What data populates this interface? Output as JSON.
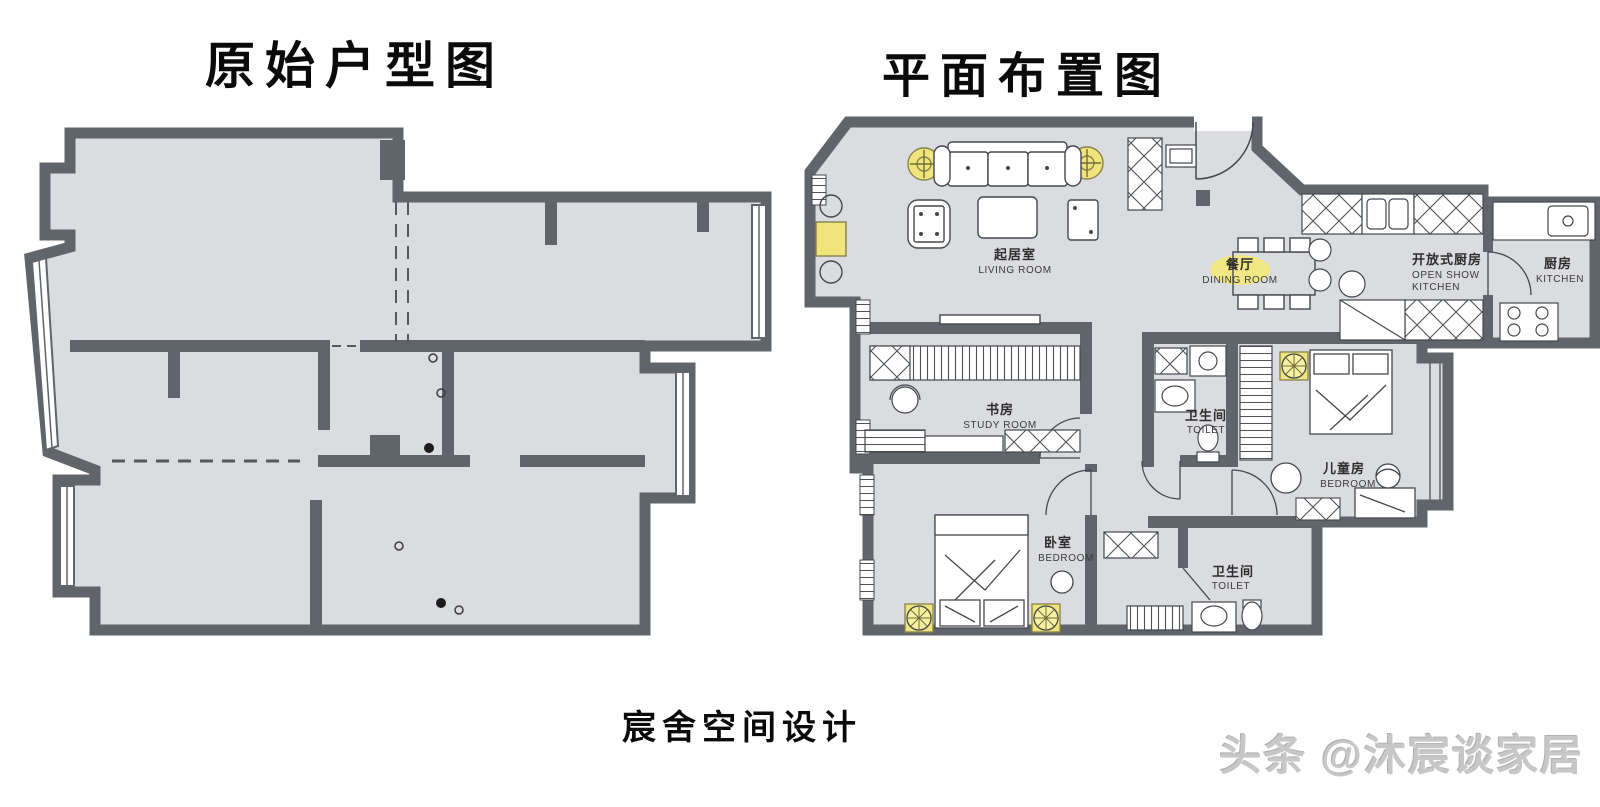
{
  "titles": {
    "left": "原始户型图",
    "right": "平面布置图"
  },
  "footer": {
    "studio": "宸舍空间设计"
  },
  "watermark": {
    "text": "头条 @沐宸谈家居"
  },
  "colors": {
    "wall": "#60656c",
    "floor": "#dbdcdf",
    "furniture_line": "#44484d",
    "lamp_yellow": "#f0e57c",
    "background": "#ffffff",
    "watermark_gray": "#c7c7c7"
  },
  "right_plan": {
    "rooms": [
      {
        "key": "living",
        "zh": "起居室",
        "en": "LIVING ROOM"
      },
      {
        "key": "dining",
        "zh": "餐厅",
        "en": "DINING ROOM"
      },
      {
        "key": "open_kitchen",
        "zh": "开放式厨房",
        "en_line1": "OPEN SHOW",
        "en_line2": "KITCHEN"
      },
      {
        "key": "kitchen",
        "zh": "厨房",
        "en": "KITCHEN"
      },
      {
        "key": "study",
        "zh": "书房",
        "en": "STUDY ROOM"
      },
      {
        "key": "toilet_main",
        "zh": "卫生间",
        "en": "TOILET"
      },
      {
        "key": "kids",
        "zh": "儿童房",
        "en": "BEDROOM"
      },
      {
        "key": "bedroom",
        "zh": "卧室",
        "en": "BEDROOM"
      },
      {
        "key": "toilet_second",
        "zh": "卫生间",
        "en": "TOILET"
      }
    ]
  }
}
